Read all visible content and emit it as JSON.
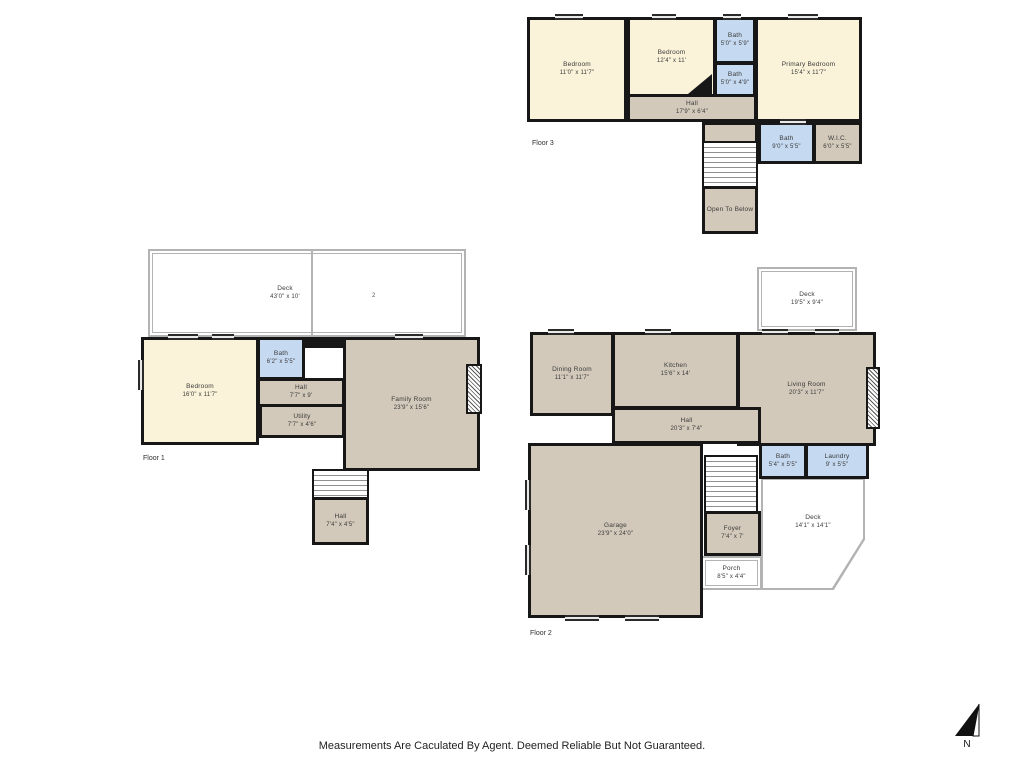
{
  "page": {
    "disclaimer": "Measurements Are Caculated By Agent. Deemed Reliable But Not Guaranteed.",
    "north_label": "N"
  },
  "colors": {
    "room_cream": "#FAF3D9",
    "room_tan": "#D2C9BA",
    "room_blue": "#C5D9F1",
    "wall": "#171717",
    "deck_outline": "#B3B3B3"
  },
  "floors": [
    {
      "label": "Floor 3",
      "rooms": [
        {
          "name": "Bedroom",
          "dims": "11'0\" x 11'7\""
        },
        {
          "name": "Bedroom",
          "dims": "12'4\" x 11'"
        },
        {
          "name": "Bath",
          "dims": "5'0\" x 5'9\""
        },
        {
          "name": "Bath",
          "dims": "5'0\" x 4'9\""
        },
        {
          "name": "Primary Bedroom",
          "dims": "15'4\" x 11'7\""
        },
        {
          "name": "Hall",
          "dims": "17'9\" x 6'4\""
        },
        {
          "name": "Bath",
          "dims": "9'0\" x 5'5\""
        },
        {
          "name": "W.I.C.",
          "dims": "6'0\" x 5'5\""
        },
        {
          "name": "Open To Below",
          "dims": ""
        }
      ]
    },
    {
      "label": "Floor 1",
      "deck_mark": "2",
      "rooms": [
        {
          "name": "Deck",
          "dims": "43'0\" x 10'"
        },
        {
          "name": "Bedroom",
          "dims": "16'0\" x 11'7\""
        },
        {
          "name": "Bath",
          "dims": "6'2\" x 5'5\""
        },
        {
          "name": "Hall",
          "dims": "7'7\" x 9'"
        },
        {
          "name": "Utility",
          "dims": "7'7\" x 4'6\""
        },
        {
          "name": "Family Room",
          "dims": "23'9\" x 15'6\""
        },
        {
          "name": "Hall",
          "dims": "7'4\" x 4'5\""
        }
      ]
    },
    {
      "label": "Floor 2",
      "rooms": [
        {
          "name": "Deck",
          "dims": "19'5\" x 9'4\""
        },
        {
          "name": "Dining Room",
          "dims": "11'1\" x 11'7\""
        },
        {
          "name": "Kitchen",
          "dims": "15'6\" x 14'"
        },
        {
          "name": "Living Room",
          "dims": "20'3\" x 11'7\""
        },
        {
          "name": "Hall",
          "dims": "20'3\" x 7'4\""
        },
        {
          "name": "Bath",
          "dims": "5'4\" x 5'5\""
        },
        {
          "name": "Laundry",
          "dims": "9' x 5'5\""
        },
        {
          "name": "Garage",
          "dims": "23'9\" x 24'0\""
        },
        {
          "name": "Foyer",
          "dims": "7'4\" x 7'"
        },
        {
          "name": "Porch",
          "dims": "8'5\" x 4'4\""
        },
        {
          "name": "Deck",
          "dims": "14'1\" x 14'1\""
        }
      ]
    }
  ]
}
